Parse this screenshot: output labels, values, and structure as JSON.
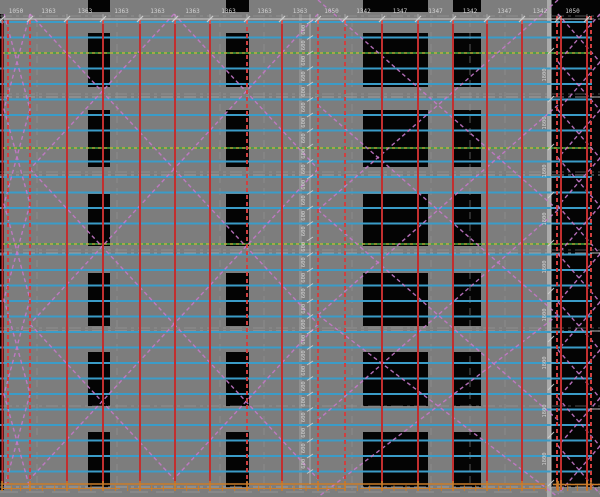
{
  "drawing": {
    "title": "scaffold-facade-elevation",
    "dimensions": {
      "top_chain": [
        "1050",
        "1363",
        "1363",
        "1363",
        "1363",
        "1363",
        "1363",
        "1363",
        "1363",
        "1050",
        "1342",
        "1347",
        "1347",
        "1342",
        "1347",
        "1342",
        "1050"
      ],
      "mid_vertical_chain": {
        "label": "600",
        "count": 29
      },
      "right_vertical_chain": {
        "label": "1800",
        "count": 9
      }
    },
    "colors": {
      "background": "#7d7d7d",
      "window": "#040404",
      "standard_red": "#c22f2f",
      "standard_red_dashed": "#d04040",
      "ledger_cyan": "#3b9cc8",
      "brace_magenta": "#c678ca",
      "tie_yellow": "#b5b53a",
      "tie_green": "#3fa53f",
      "base_orange": "#c97c2a",
      "dim_text": "#d2d2d2",
      "floor_line": "#a8a8a8",
      "corner_band": "#b2b2b2"
    }
  }
}
